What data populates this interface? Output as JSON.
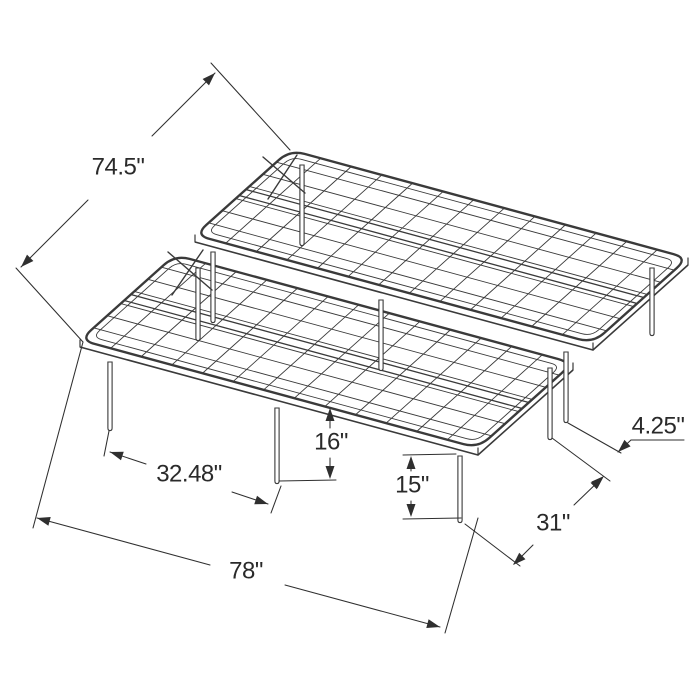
{
  "diagram": {
    "background": "#ffffff",
    "stroke_color": "#3a3a3a",
    "dim_color": "#2f2f2f",
    "label_color": "#2a2a2a",
    "label_font_size": 24,
    "subject": "folding-platform-bed-frame-isometric-line-drawing",
    "frame": {
      "corner_radius": 15,
      "inset": 6,
      "skirt_drop": 7,
      "cross_wires": 12,
      "long_wires": 6,
      "channel_span": [
        0.465,
        0.535
      ],
      "halves": [
        {
          "name": "rear-half",
          "FL": [
            195,
            235
          ],
          "FR": [
            593,
            343
          ],
          "RR": [
            688,
            258
          ],
          "RL": [
            290,
            150
          ]
        },
        {
          "name": "front-half",
          "FL": [
            80,
            340
          ],
          "FR": [
            478,
            448
          ],
          "RR": [
            573,
            363
          ],
          "RL": [
            175,
            255
          ]
        }
      ],
      "legs": [
        {
          "name": "front-left-corner-leg",
          "top": [
            110,
            362
          ],
          "foot": [
            110,
            428
          ]
        },
        {
          "name": "front-mid-leg",
          "top": [
            277,
            408
          ],
          "foot": [
            277,
            481
          ]
        },
        {
          "name": "front-right-corner-leg",
          "top": [
            460,
            456
          ],
          "foot": [
            460,
            520
          ]
        },
        {
          "name": "front-half-rear-right-leg",
          "top": [
            550,
            368
          ],
          "foot": [
            550,
            437
          ]
        },
        {
          "name": "rear-half-front-right-leg",
          "top": [
            566,
            352
          ],
          "foot": [
            566,
            420
          ]
        },
        {
          "name": "front-half-rear-left-leg",
          "top": [
            198,
            268
          ],
          "foot": [
            198,
            338
          ]
        },
        {
          "name": "rear-half-front-left-leg",
          "top": [
            213,
            252
          ],
          "foot": [
            213,
            320
          ]
        },
        {
          "name": "rear-right-corner-leg",
          "top": [
            652,
            268
          ],
          "foot": [
            652,
            333
          ]
        },
        {
          "name": "rear-left-corner-leg",
          "top": [
            302,
            165
          ],
          "foot": [
            302,
            243
          ]
        },
        {
          "name": "rear-half-front-mid-leg",
          "top": [
            381,
            300
          ],
          "foot": [
            381,
            368
          ]
        }
      ],
      "x_braces": [
        {
          "segments": [
            [
              [
                263,
                157
              ],
              [
                305,
                193
              ]
            ],
            [
              [
                297,
                155
              ],
              [
                268,
                199
              ]
            ]
          ]
        },
        {
          "segments": [
            [
              [
                168,
                252
              ],
              [
                212,
                290
              ]
            ],
            [
              [
                203,
                250
              ],
              [
                172,
                295
              ]
            ]
          ]
        }
      ]
    },
    "dimensions": [
      {
        "id": "overall-depth",
        "label": "74.5\"",
        "label_pos": [
          118,
          168
        ],
        "ext_lines": [
          [
            [
              83,
              342
            ],
            [
              16,
              268
            ]
          ],
          [
            [
              290,
              150
            ],
            [
              211,
              63
            ]
          ]
        ],
        "segments": [
          [
            [
              21,
              267
            ],
            [
              88,
              200
            ]
          ],
          [
            [
              152,
              136
            ],
            [
              215,
              73
            ]
          ]
        ],
        "arrows": [
          {
            "tip": [
              21,
              267
            ],
            "angle": 135
          },
          {
            "tip": [
              215,
              73
            ],
            "angle": -45
          }
        ]
      },
      {
        "id": "overall-width",
        "label": "78\"",
        "label_pos": [
          246,
          572
        ],
        "ext_lines": [
          [
            [
              83,
              342
            ],
            [
              33,
              528
            ]
          ],
          [
            [
              478,
              518
            ],
            [
              445,
              633
            ]
          ]
        ],
        "segments": [
          [
            [
              37,
              518
            ],
            [
              210,
              565
            ]
          ],
          [
            [
              285,
              585
            ],
            [
              440,
              627
            ]
          ]
        ],
        "arrows": [
          {
            "tip": [
              37,
              518
            ],
            "angle": 195
          },
          {
            "tip": [
              440,
              627
            ],
            "angle": 15
          }
        ]
      },
      {
        "id": "front-leg-spacing",
        "label": "32.48\"",
        "label_pos": [
          189,
          475
        ],
        "ext_lines": [
          [
            [
              109,
              431
            ],
            [
              104,
              456
            ]
          ],
          [
            [
              281,
              486
            ],
            [
              271,
              513
            ]
          ]
        ],
        "segments": [
          [
            [
              110,
              452
            ],
            [
              146,
              464
            ]
          ],
          [
            [
              232,
              492
            ],
            [
              268,
              504
            ]
          ]
        ],
        "arrows": [
          {
            "tip": [
              110,
              452
            ],
            "angle": 198
          },
          {
            "tip": [
              268,
              504
            ],
            "angle": 18
          }
        ]
      },
      {
        "id": "frame-height",
        "label": "16\"",
        "label_pos": [
          331,
          443
        ],
        "ext_lines": [
          [
            [
              279,
              481
            ],
            [
              336,
              480
            ]
          ]
        ],
        "segments": [
          [
            [
              330,
              411
            ],
            [
              330,
              428
            ]
          ],
          [
            [
              330,
              458
            ],
            [
              330,
              476
            ]
          ]
        ],
        "arrows": [
          {
            "tip": [
              330,
              408
            ],
            "angle": -90
          },
          {
            "tip": [
              330,
              479
            ],
            "angle": 90
          }
        ]
      },
      {
        "id": "leg-height",
        "label": "15\"",
        "label_pos": [
          412,
          486
        ],
        "ext_lines": [
          [
            [
              403,
              455
            ],
            [
              456,
              454
            ]
          ],
          [
            [
              403,
              519
            ],
            [
              461,
              518
            ]
          ]
        ],
        "segments": [
          [
            [
              411,
              458
            ],
            [
              411,
              471
            ]
          ],
          [
            [
              411,
              501
            ],
            [
              411,
              514
            ]
          ]
        ],
        "arrows": [
          {
            "tip": [
              411,
              456
            ],
            "angle": -90
          },
          {
            "tip": [
              411,
              517
            ],
            "angle": 90
          }
        ]
      },
      {
        "id": "side-leg-spacing",
        "label": "31\"",
        "label_pos": [
          553,
          524
        ],
        "ext_lines": [
          [
            [
              465,
              524
            ],
            [
              520,
              566
            ]
          ],
          [
            [
              552,
              438
            ],
            [
              610,
              481
            ]
          ]
        ],
        "segments": [
          [
            [
              601,
              479
            ],
            [
              574,
              505
            ]
          ],
          [
            [
              533,
              545
            ],
            [
              514,
              564
            ]
          ]
        ],
        "arrows": [
          {
            "tip": [
              603,
              477
            ],
            "angle": -44
          },
          {
            "tip": [
              513,
              565
            ],
            "angle": 136
          }
        ]
      },
      {
        "id": "frame-gap",
        "label": "4.25\"",
        "label_pos": [
          658,
          427
        ],
        "ext_lines": [
          [
            [
              568,
              423
            ],
            [
              621,
              453
            ]
          ]
        ],
        "segments": [
          [
            [
              618,
              452
            ],
            [
              631,
              440
            ]
          ],
          [
            [
              631,
              440
            ],
            [
              684,
              440
            ]
          ]
        ],
        "arrows": [
          {
            "tip": [
              618,
              452
            ],
            "angle": 137
          },
          {
            "tip": [
              604,
              476
            ],
            "angle": -43
          }
        ]
      }
    ]
  }
}
